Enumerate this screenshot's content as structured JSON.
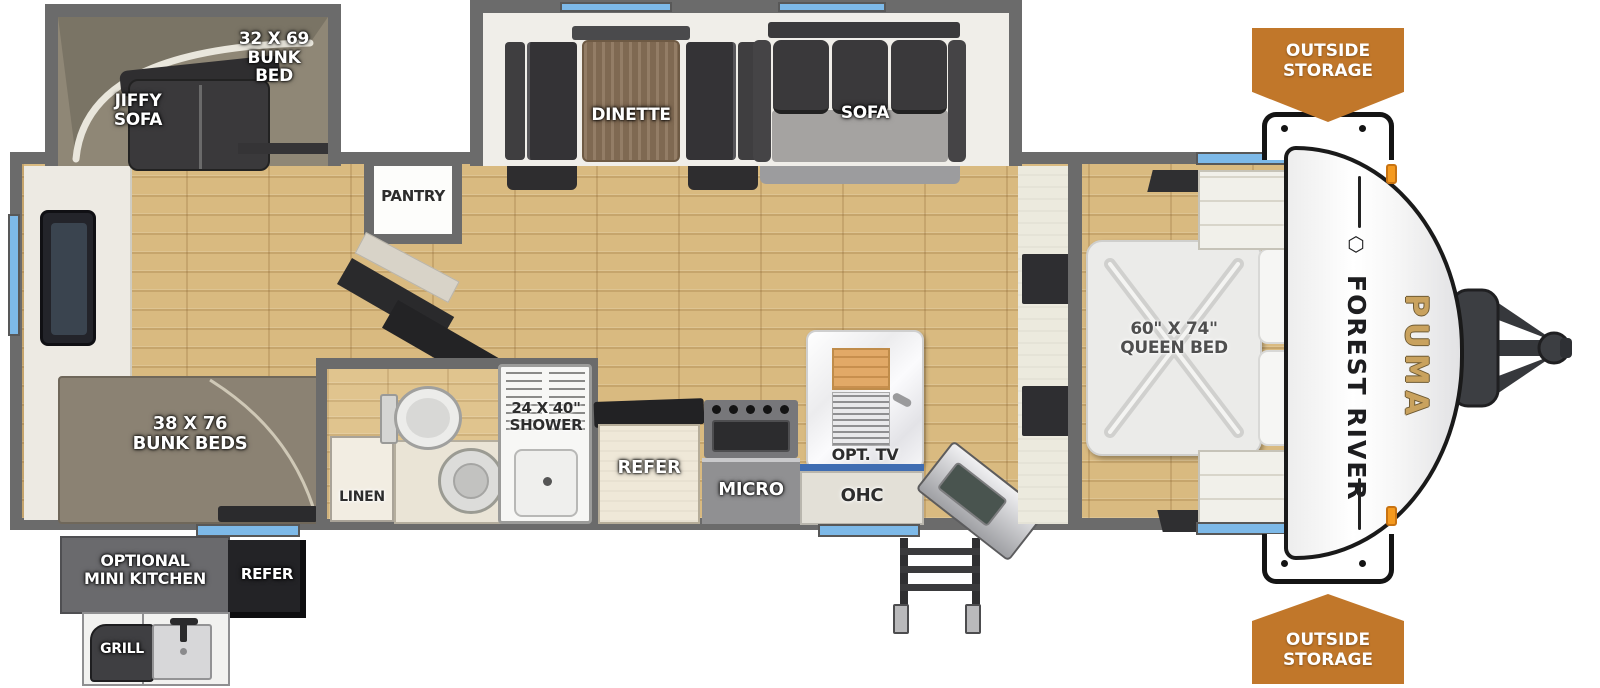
{
  "title": "Forest River Puma travel trailer floor plan",
  "colors": {
    "wall": "#6b6b6b",
    "floor_wood": "#d9ba80",
    "window_blue": "#7db9e8",
    "banner_orange": "#c1772a",
    "brand_black": "#1e1e20",
    "model_gold": "#c9a25e"
  },
  "icons": {
    "forest_river_logo_glyph": "⬡"
  },
  "labels": {
    "bunk_bed_32": "32 X 69\nBUNK\nBED",
    "jiffy_sofa": "JIFFY\nSOFA",
    "dinette": "DINETTE",
    "sofa": "SOFA",
    "pantry": "PANTRY",
    "bunk_beds_38": "38 X 76\nBUNK BEDS",
    "linen": "LINEN",
    "shower": "24 X 40\"\nSHOWER",
    "refer": "REFER",
    "micro": "MICRO",
    "opt_tv": "OPT. TV",
    "ohc": "OHC",
    "queen_bed": "60\" X 74\"\nQUEEN BED",
    "closet_top": "CLOSET",
    "closet_bottom": "CLOSET",
    "outside_storage_top": "OUTSIDE\nSTORAGE",
    "outside_storage_bottom": "OUTSIDE\nSTORAGE",
    "optional_mini_kitchen": "OPTIONAL\nMINI KITCHEN",
    "outside_refer": "REFER",
    "grill": "GRILL",
    "brand": "FOREST RIVER",
    "model": "PUMA"
  }
}
